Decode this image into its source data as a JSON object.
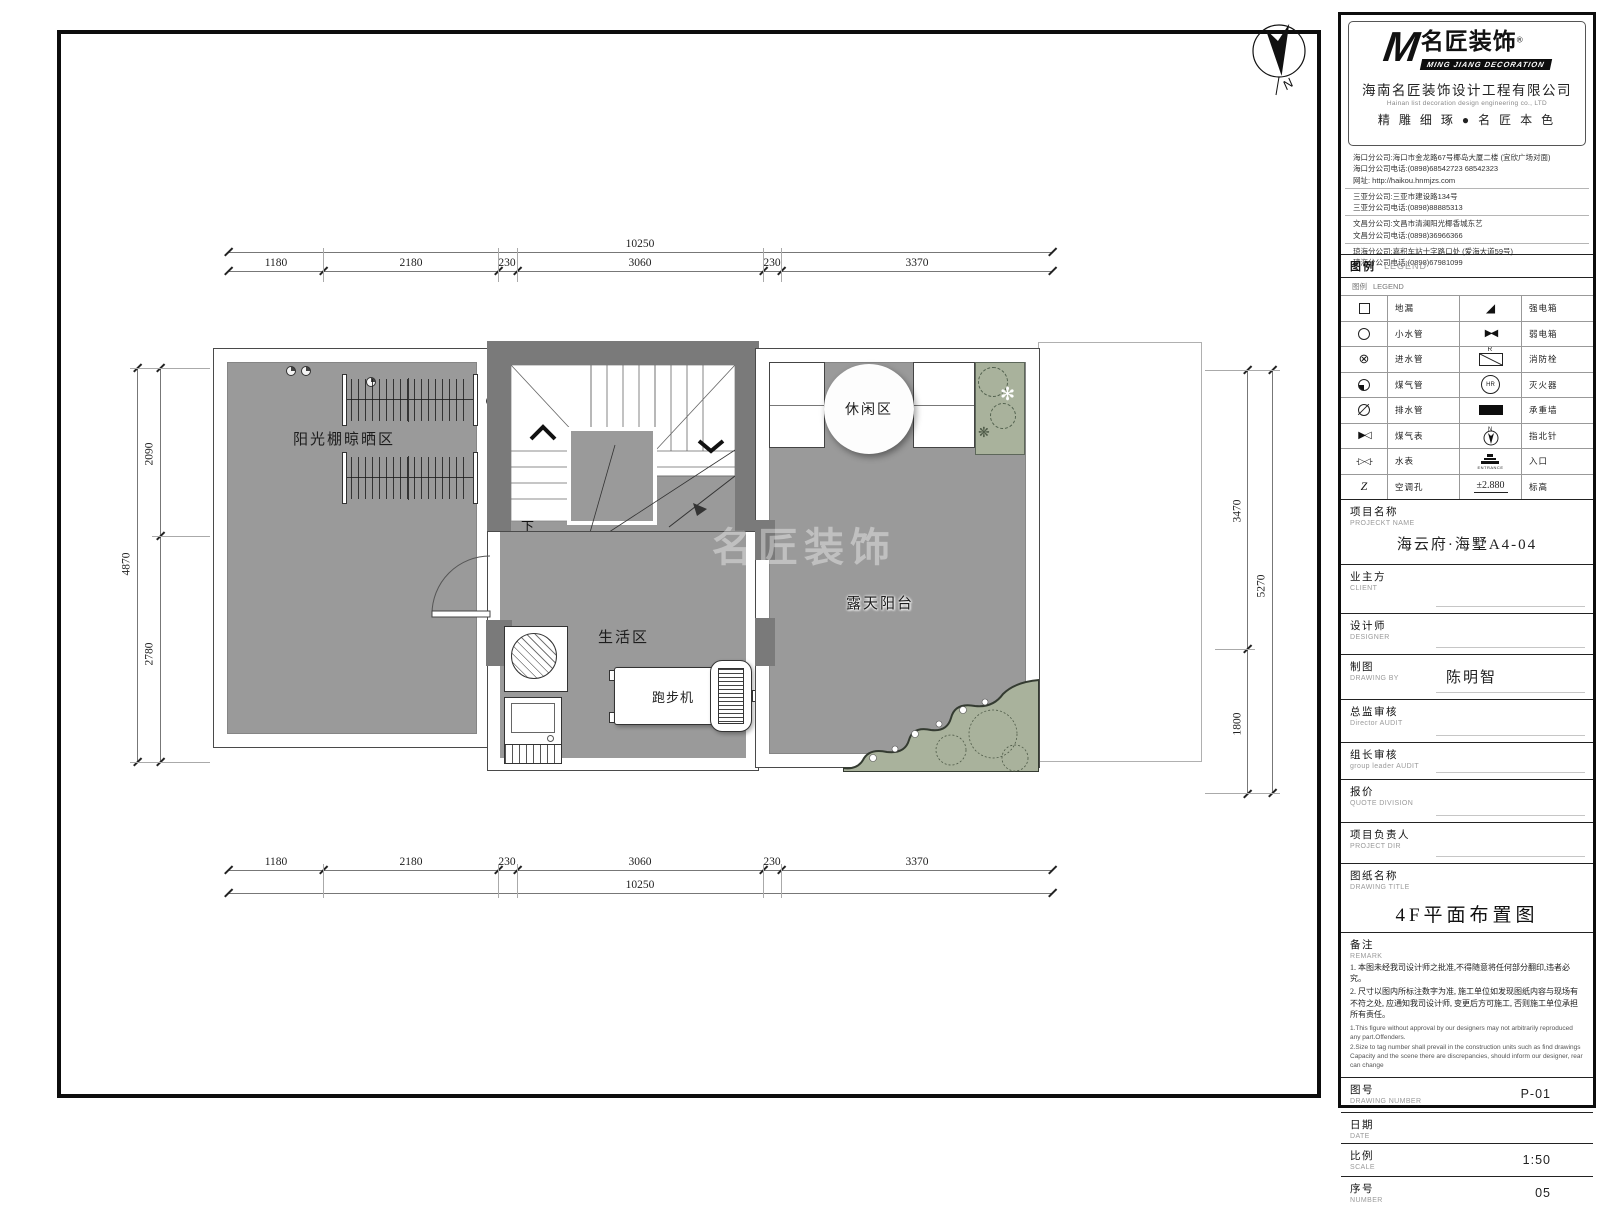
{
  "north": {
    "label": "N"
  },
  "plan": {
    "watermark": "名匠装饰",
    "labels": {
      "sun_area": "阳光棚晾晒区",
      "leisure": "休闲区",
      "living": "生活区",
      "terrace": "露天阳台",
      "treadmill": "跑步机",
      "down": "下"
    },
    "dims": {
      "top_total": "10250",
      "top_segments": [
        "1180",
        "2180",
        "230",
        "3060",
        "230",
        "3370"
      ],
      "bottom_segments": [
        "1180",
        "2180",
        "230",
        "3060",
        "230",
        "3370"
      ],
      "bottom_total": "10250",
      "left_total": "4870",
      "left_segments": [
        "2090",
        "2780"
      ],
      "right_segments": [
        "3470",
        "1800"
      ],
      "right_total": "5270"
    }
  },
  "titleblock": {
    "logo": {
      "m": "M",
      "cn": "名匠装饰",
      "reg": "®",
      "en": "MING JIANG DECORATION"
    },
    "company": {
      "name_cn": "海南名匠装饰设计工程有限公司",
      "name_en": "Hainan list decoration design engineering co., LTD",
      "slogan": "精 雕 细 琢 ● 名 匠 本 色"
    },
    "branches": [
      [
        "海口分公司:海口市金龙路67号椰岛大厦二楼 (宜欣广场对面)",
        "海口分公司电话:(0898)68542723 68542323",
        "网址: http://haikou.hnmjzs.com"
      ],
      [
        "三亚分公司:三亚市建设路134号",
        "三亚分公司电话:(0898)88885313"
      ],
      [
        "文昌分公司:文昌市清澜阳光椰香城东艺",
        "文昌分公司电话:(0898)36966366"
      ],
      [
        "琼海分公司:嘉积车站十字路口处 (爱海大道59号)",
        "琼海分公司电话:(0898)67981099"
      ]
    ],
    "legend": {
      "title_cn": "图例",
      "title_en": "LEGEND",
      "rows": [
        {
          "l1": "地漏",
          "l2": "强电箱"
        },
        {
          "l1": "小水管",
          "l2": "弱电箱"
        },
        {
          "l1": "进水管",
          "l2": "消防栓"
        },
        {
          "l1": "煤气管",
          "l2": "灭火器"
        },
        {
          "l1": "排水管",
          "l2": "承重墙"
        },
        {
          "l1": "煤气表",
          "l2": "指北针"
        },
        {
          "l1": "水表",
          "l2": "入口"
        },
        {
          "l1": "空调孔",
          "l2": "标高"
        }
      ],
      "hr": "HR",
      "hydrant_r": "R",
      "entrance": "ENTRANCE",
      "elevation": "±2.880",
      "north_n": "N",
      "gas_meter": "▶◁",
      "water_meter": "-▷◁-",
      "weak_box": "▶◀",
      "strong_box": "◢",
      "ac_hole": "Z",
      "inlet": "⊗"
    },
    "fields": {
      "project": {
        "cn": "项目名称",
        "en": "PROJECKT NAME",
        "value": "海云府·海墅A4-04"
      },
      "client": {
        "cn": "业主方",
        "en": "CLIENT",
        "value": ""
      },
      "designer": {
        "cn": "设计师",
        "en": "DESIGNER",
        "value": ""
      },
      "drawing_by": {
        "cn": "制图",
        "en": "DRAWING BY",
        "value": "陈明智"
      },
      "director_audit": {
        "cn": "总监审核",
        "en": "Director AUDIT",
        "value": ""
      },
      "leader_audit": {
        "cn": "组长审核",
        "en": "group leader AUDIT",
        "value": ""
      },
      "quote": {
        "cn": "报价",
        "en": "QUOTE DIVISION",
        "value": ""
      },
      "project_dir": {
        "cn": "项目负责人",
        "en": "PROJECT DIR",
        "value": ""
      },
      "drawing_title": {
        "cn": "图纸名称",
        "en": "DRAWING TITLE",
        "value": "4F平面布置图"
      },
      "remark": {
        "cn": "备注",
        "en": "REMARK",
        "notes_cn": [
          "1. 本图未经我司设计师之批准,不得随意将任何部分翻印,违者必究。",
          "2. 尺寸以图内所标注数字为准, 施工单位如发现图纸内容与现场有不符之处, 应通知我司设计师, 变更后方可施工, 否则施工单位承担所有责任。"
        ],
        "notes_en": [
          "1.This figure without approval by our designers may not arbitrarily reproduced any part.Offenders.",
          "2.Size to tag number shall prevail in the construction units such as find drawings Capacity and the scene there are discrepancies, should inform our designer, rear can change"
        ]
      },
      "drawing_number": {
        "cn": "图号",
        "en": "DRAWING NUMBER",
        "value": "P-01"
      },
      "date": {
        "cn": "日期",
        "en": "DATE",
        "value": ""
      },
      "scale": {
        "cn": "比例",
        "en": "SCALE",
        "value": "1:50"
      },
      "number": {
        "cn": "序号",
        "en": "NUMBER",
        "value": "05"
      }
    }
  }
}
